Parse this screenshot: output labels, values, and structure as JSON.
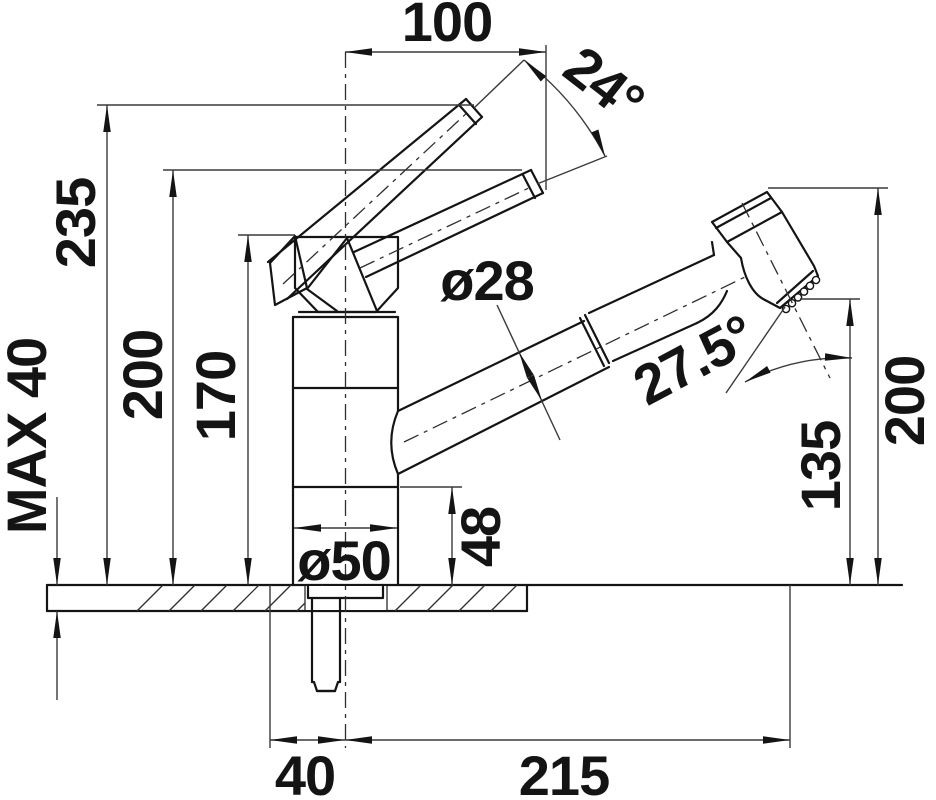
{
  "drawing": {
    "kind": "faucet-installation-dimension-drawing",
    "dimensions": {
      "top_projection": "100",
      "lever_angle": "24°",
      "overall_height": "235",
      "lever_height": "200",
      "body_height": "170",
      "max_mounting_thickness": "MAX 40",
      "spout_diameter": "ø28",
      "spray_angle": "27.5°",
      "outlet_height": "135",
      "head_height": "200",
      "base_height": "48",
      "base_diameter": "ø50",
      "hole_offset": "40",
      "spout_reach": "215"
    },
    "colors": {
      "line": "#141414",
      "dimension_line": "#3a3a3a",
      "background": "#ffffff"
    }
  }
}
